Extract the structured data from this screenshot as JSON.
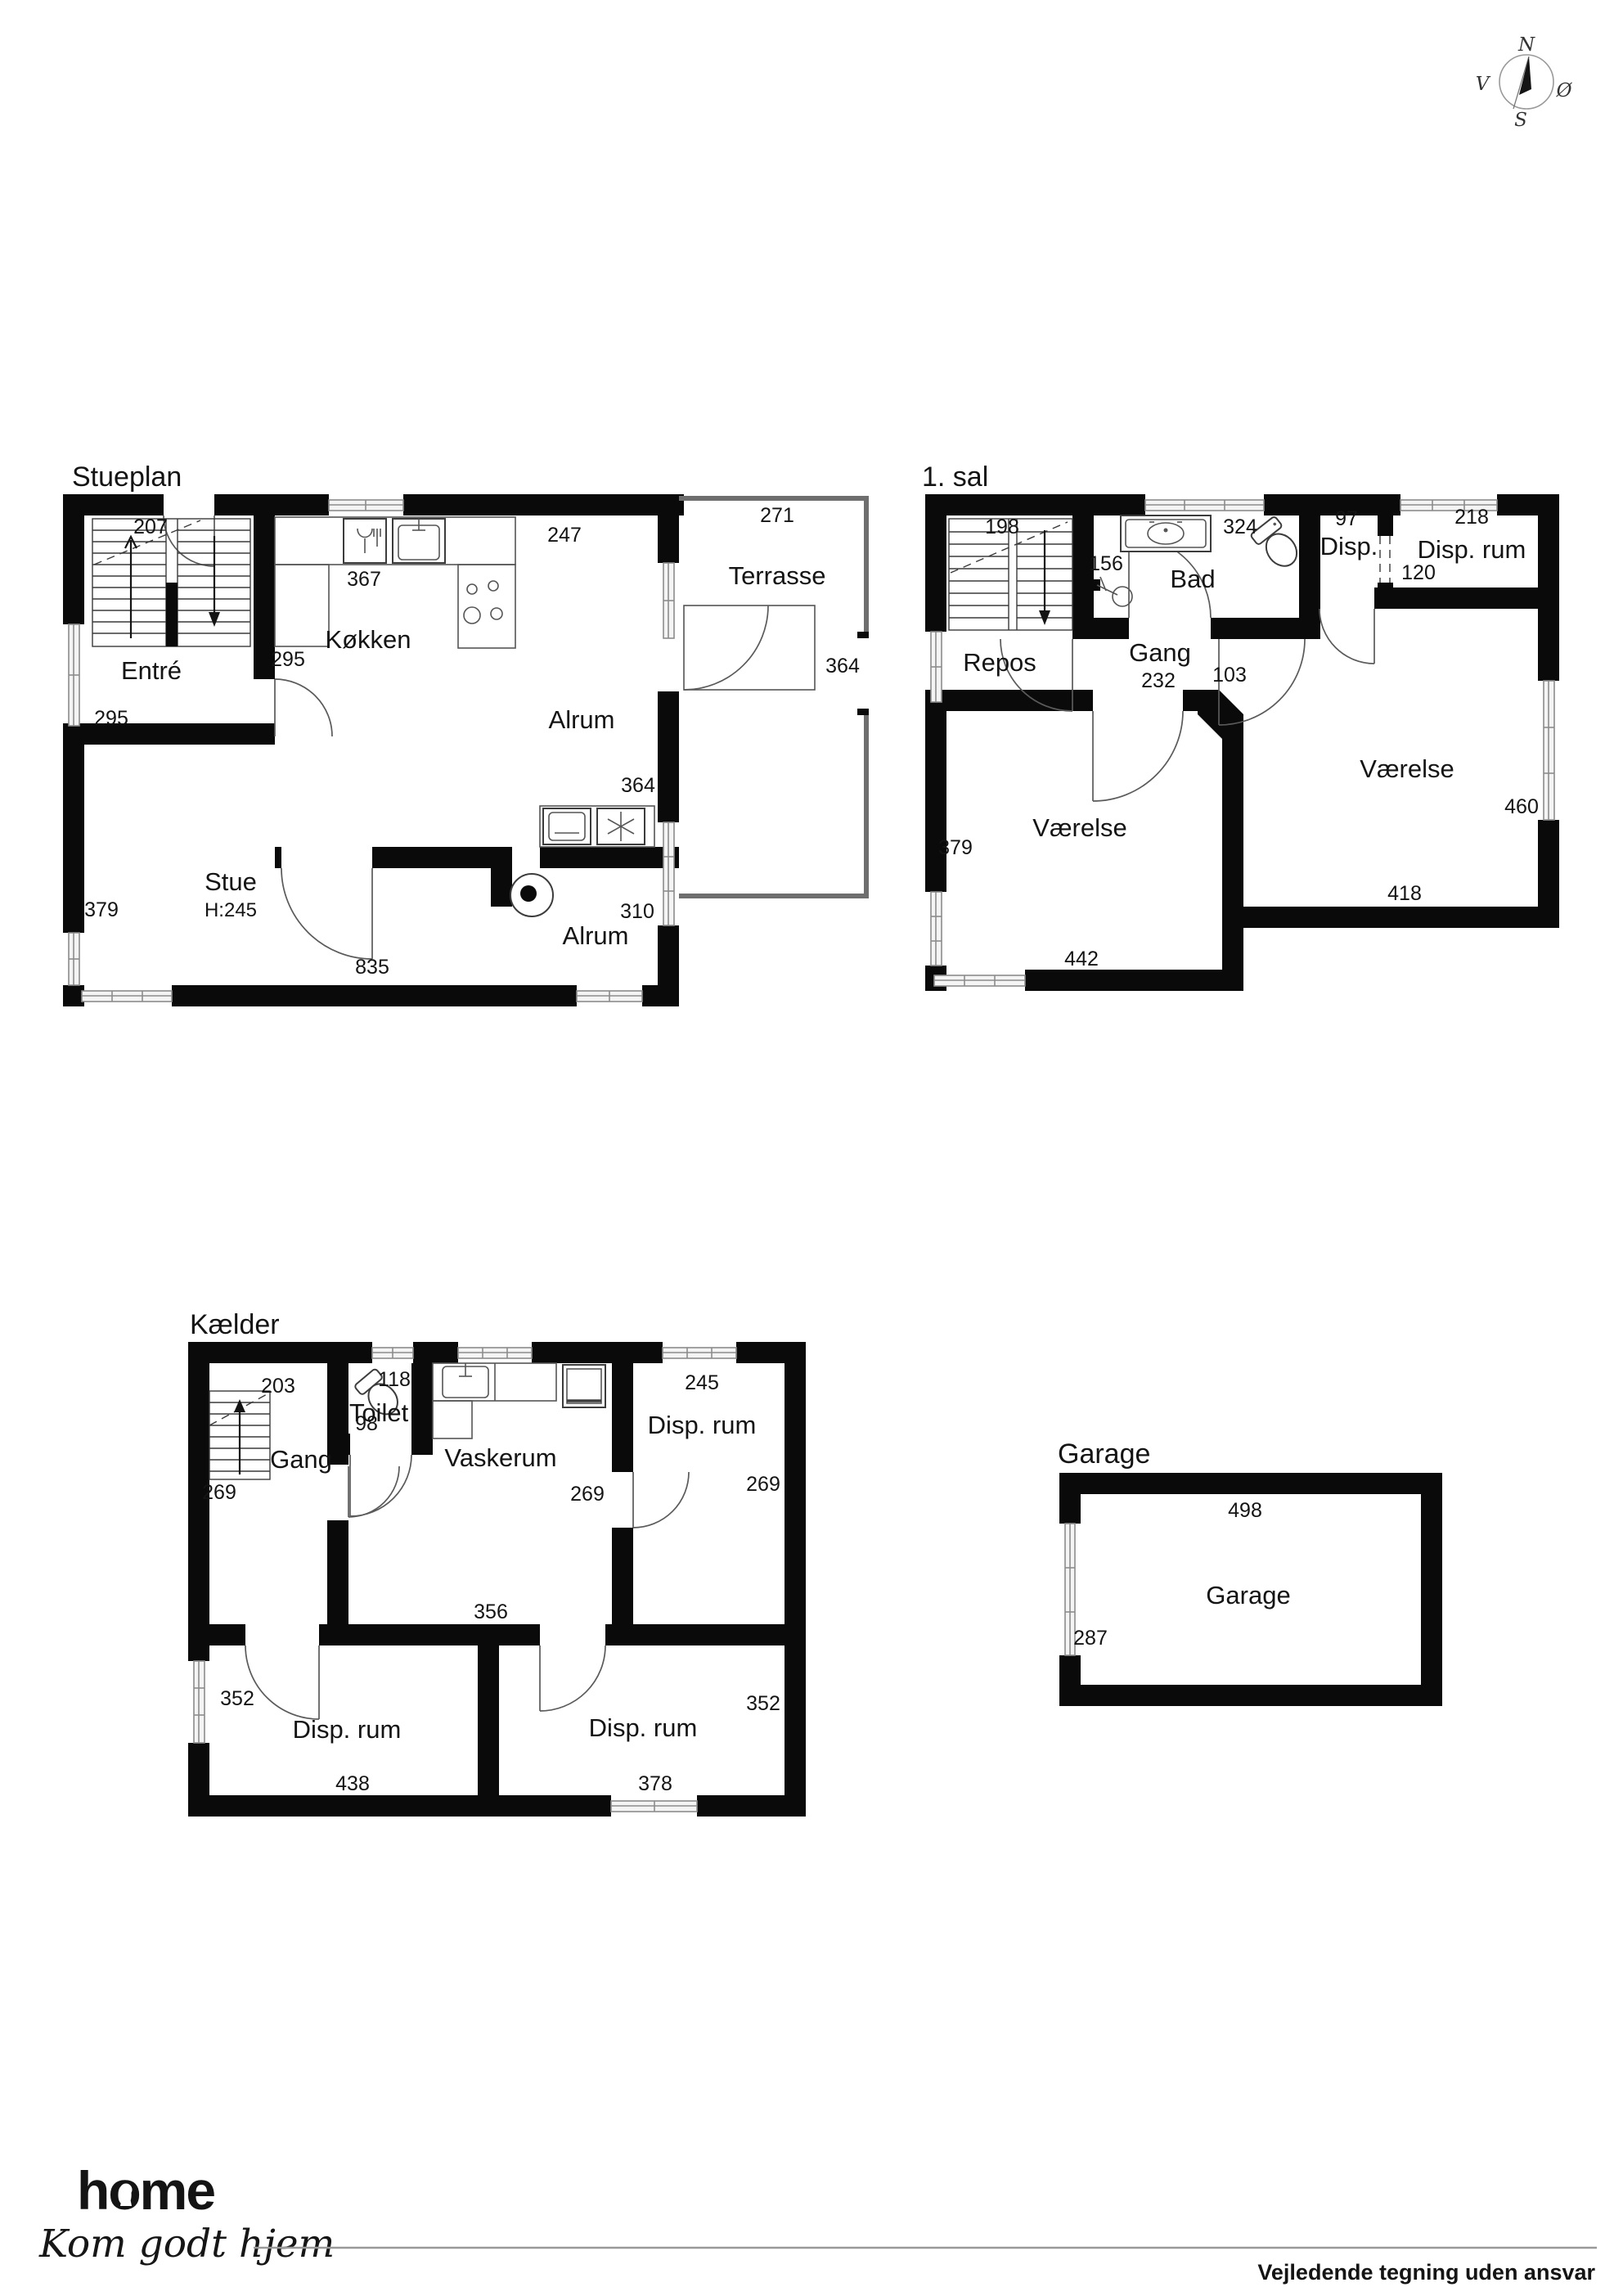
{
  "compass": {
    "n": "N",
    "s": "S",
    "v": "V",
    "east": "Ø"
  },
  "stueplan": {
    "title": "Stueplan",
    "rooms": {
      "entre": "Entré",
      "kokken": "Køkken",
      "alrum_top": "Alrum",
      "terrasse": "Terrasse",
      "stue": "Stue",
      "stue_height": "H:245",
      "alrum_bottom": "Alrum"
    },
    "dims": {
      "entre_top": "207",
      "entre_left": "295",
      "kokken_door": "295",
      "kokken_top": "367",
      "alrum_top": "247",
      "alrum_right": "364",
      "terrasse_top": "271",
      "terrasse_right": "364",
      "stue_left": "379",
      "stue_bottom": "835",
      "alrum_bottom_right": "310"
    }
  },
  "first_floor": {
    "title": "1. sal",
    "rooms": {
      "repos": "Repos",
      "gang": "Gang",
      "bad": "Bad",
      "disp": "Disp.",
      "disp_rum": "Disp. rum",
      "vaerelse_left": "Værelse",
      "vaerelse_right": "Værelse"
    },
    "dims": {
      "stairs": "198",
      "shower": "156",
      "bad": "324",
      "disp": "97",
      "disp_rum": "218",
      "disp_opening": "120",
      "gang": "232",
      "gang_door": "103",
      "vaerelse_left_side": "379",
      "vaerelse_left_bottom": "442",
      "vaerelse_right_side": "460",
      "vaerelse_right_bottom": "418"
    }
  },
  "basement": {
    "title": "Kælder",
    "rooms": {
      "gang": "Gang",
      "toilet": "Toilet",
      "vaskerum": "Vaskerum",
      "disp_rum_top": "Disp. rum",
      "disp_rum_left": "Disp. rum",
      "disp_rum_right": "Disp. rum"
    },
    "dims": {
      "gang_top": "203",
      "gang_left": "269",
      "toilet_top": "118",
      "toilet_bottom": "98",
      "vaskerum_right": "269",
      "vaskerum_bottom": "356",
      "disp_top": "245",
      "disp_right": "269",
      "left_room_left": "352",
      "left_room_bottom": "438",
      "right_room_right": "352",
      "right_room_bottom": "378"
    }
  },
  "garage": {
    "title": "Garage",
    "room": "Garage",
    "dims": {
      "width": "498",
      "side": "287"
    }
  },
  "footer": {
    "brand": "home",
    "slogan": "Kom godt hjem",
    "disclaimer": "Vejledende tegning uden ansvar"
  },
  "colors": {
    "brand_red": "#e31f2b",
    "wall": "#0a0a0a"
  }
}
